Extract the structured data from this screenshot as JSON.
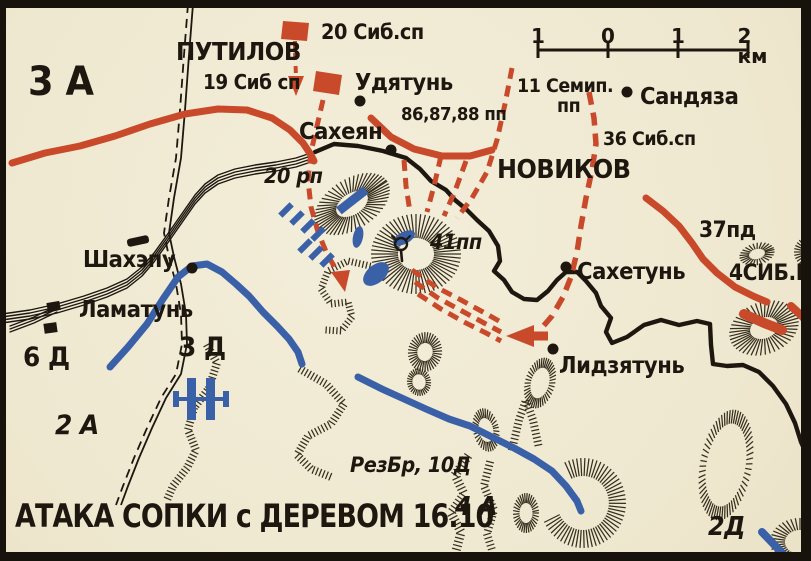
{
  "map": {
    "title": "АТАКА СОПКИ с ДЕРЕВОМ 16.10",
    "colors": {
      "background": "#f1ebd6",
      "ink": "#1d1710",
      "hachure": "#372f1e",
      "red": "#c84a2b",
      "blue": "#3a60a8"
    },
    "scale_bar": {
      "unit": "км",
      "ticks": [
        "1",
        "0",
        "1",
        "2 км"
      ]
    },
    "commanders": {
      "putilov": "ПУТИЛОВ",
      "novikov": "НОВИКОВ"
    },
    "formations": {
      "a3": "3 А",
      "a2": "2 А",
      "a4": "4 А",
      "d6": "6 Д",
      "d3": "3 Д",
      "d2": "2Д"
    },
    "units": {
      "sib19": "19 Сиб сп",
      "sib20": "20 Сиб.сп",
      "sib36": "36 Сиб.сп",
      "semip11_line1": "11 Семип.",
      "semip11_line2": "пп",
      "pp868788": "86,87,88 пп",
      "pd37": "37пд",
      "sibk4": "4СИБ.К",
      "rp20": "20 рп",
      "pp41": "41пп",
      "rezbr": "РезБр, 10Д"
    },
    "places": {
      "udyatun": "Удятунь",
      "saheyan": "Сахеян",
      "sandyaza": "Сандяза",
      "sahetun": "Сахетунь",
      "lidzyatun": "Лидзятунь",
      "shahepu": "Шахэпу",
      "lamatun": "Ламатунь"
    }
  }
}
